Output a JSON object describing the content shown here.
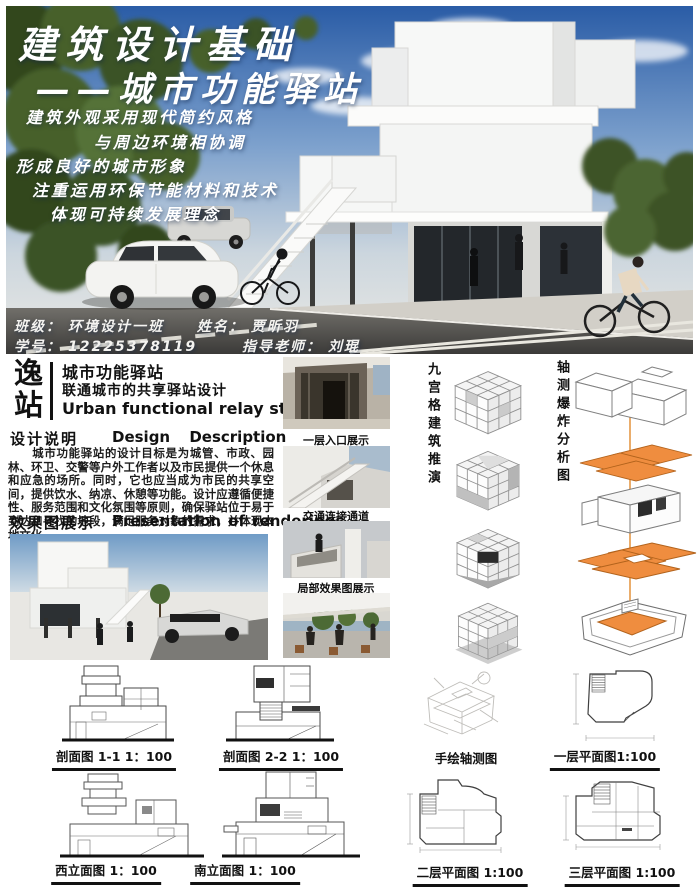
{
  "hero": {
    "title_line1": "建筑设计基础",
    "title_line2": "——城市功能驿站",
    "slogans": [
      "建筑外观采用现代简约风格",
      "与周边环境相协调",
      "形成良好的城市形象",
      "注重运用环保节能材料和技术",
      "体现可持续发展理念"
    ],
    "info": {
      "class_label": "班级：",
      "class_value": "环境设计一班",
      "name_label": "姓名：",
      "name_value": "贾昕羽",
      "id_label": "学号：",
      "id_value": "12225378119",
      "teacher_label": "指导老师：",
      "teacher_value": "刘琨"
    }
  },
  "project": {
    "logo_char1": "逸",
    "logo_char2": "站",
    "title_cn": "城市功能驿站",
    "subtitle_cn": "联通城市的共享驿站设计",
    "title_en": "Urban functional relay station"
  },
  "description": {
    "heading_cn": "设计说明",
    "heading_en": "Design Description",
    "body": "　　城市功能驿站的设计目标是为城管、市政、园林、环卫、交警等户外工作者以及市民提供一个休息和应急的场所。同时，它也应当成为市民的共享空间，提供饮水、纳凉、休憩等功能。设计应遵循便捷性、服务范围和文化氛围等原则，确保驿站位于易于到达和寻找的地段，满足服务对象的需求，并体现本地文化。"
  },
  "renderings": {
    "heading_cn": "效果图展示",
    "heading_en": "Presentation of renderings",
    "thumb_labels": [
      "一层入口展示",
      "交通连接通道",
      "局部效果图展示"
    ]
  },
  "analysis": {
    "grid_label": "九宫格建筑推演",
    "explode_label": "轴测爆炸分析图"
  },
  "drawings": {
    "section_1": "剖面图 1-1 1：100",
    "section_2": "剖面图 2-2 1：100",
    "hand_axon": "手绘轴测图",
    "plan_1": "一层平面图1:100",
    "elev_west": "西立面图 1：100",
    "elev_south": "南立面图 1：100",
    "plan_2": "二层平面图 1:100",
    "plan_3": "三层平面图 1:100"
  },
  "colors": {
    "accent_orange": "#ee8c3e"
  }
}
